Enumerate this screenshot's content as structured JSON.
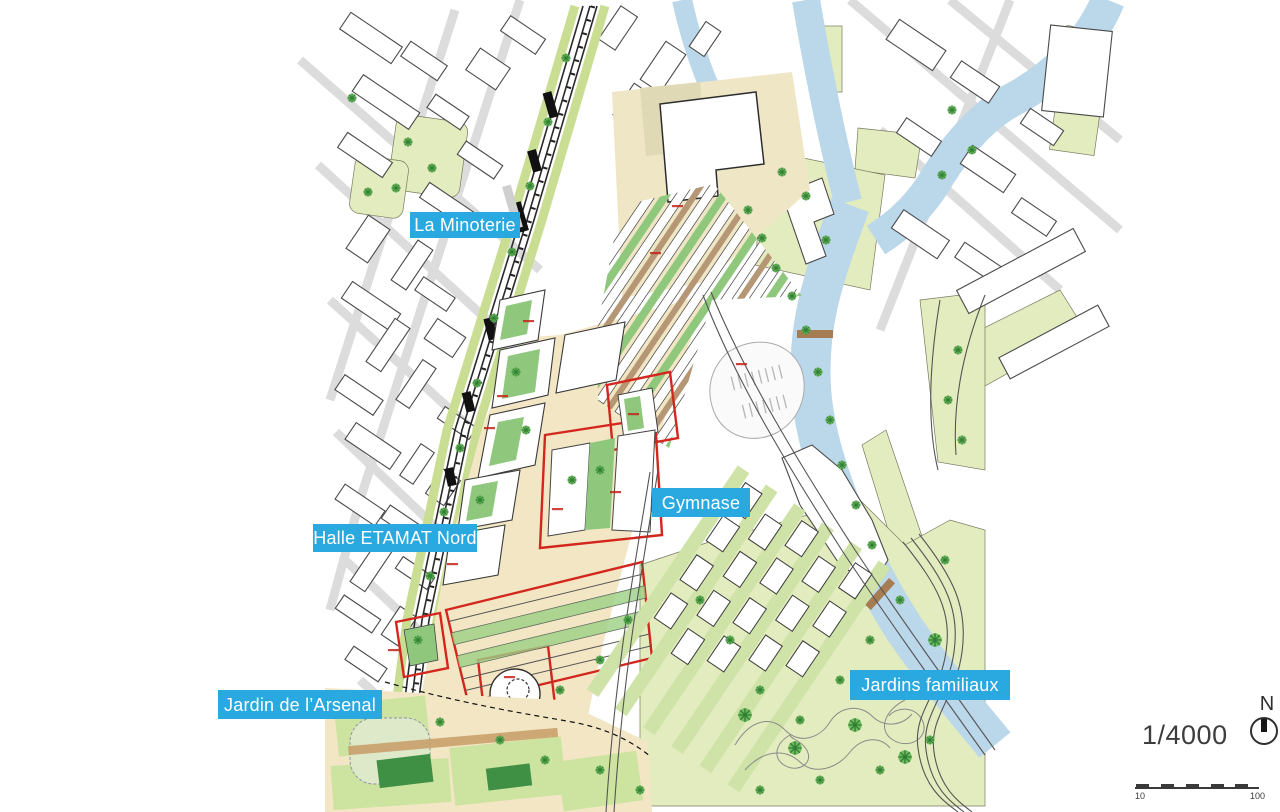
{
  "map": {
    "description": "Urban development plan (1/4000) with canal, railway and project parcels",
    "labels": [
      {
        "id": "la-minoterie",
        "text": "La Minoterie"
      },
      {
        "id": "halle-etamat-nord",
        "text": "Halle ETAMAT Nord"
      },
      {
        "id": "gymnase",
        "text": "Gymnase"
      },
      {
        "id": "jardin-arsenal",
        "text": "Jardin de l’Arsenal"
      },
      {
        "id": "jardins-familiaux",
        "text": "Jardins familiaux"
      }
    ]
  },
  "legend": {
    "scale_text": "1/4000",
    "north_label": "N",
    "scale_bar": {
      "start_label": "10",
      "end_label": "100"
    }
  },
  "colors": {
    "label_bg": "#29A9E0",
    "label_text": "#FFFFFF",
    "water": "#BBD7EA",
    "green_area": "#E3ECBE",
    "courtyard_green": "#8FC87C",
    "project_street_beige": "#F2E6C4",
    "parcel_red": "#D3261D",
    "building_outline": "#3A3A3A"
  }
}
